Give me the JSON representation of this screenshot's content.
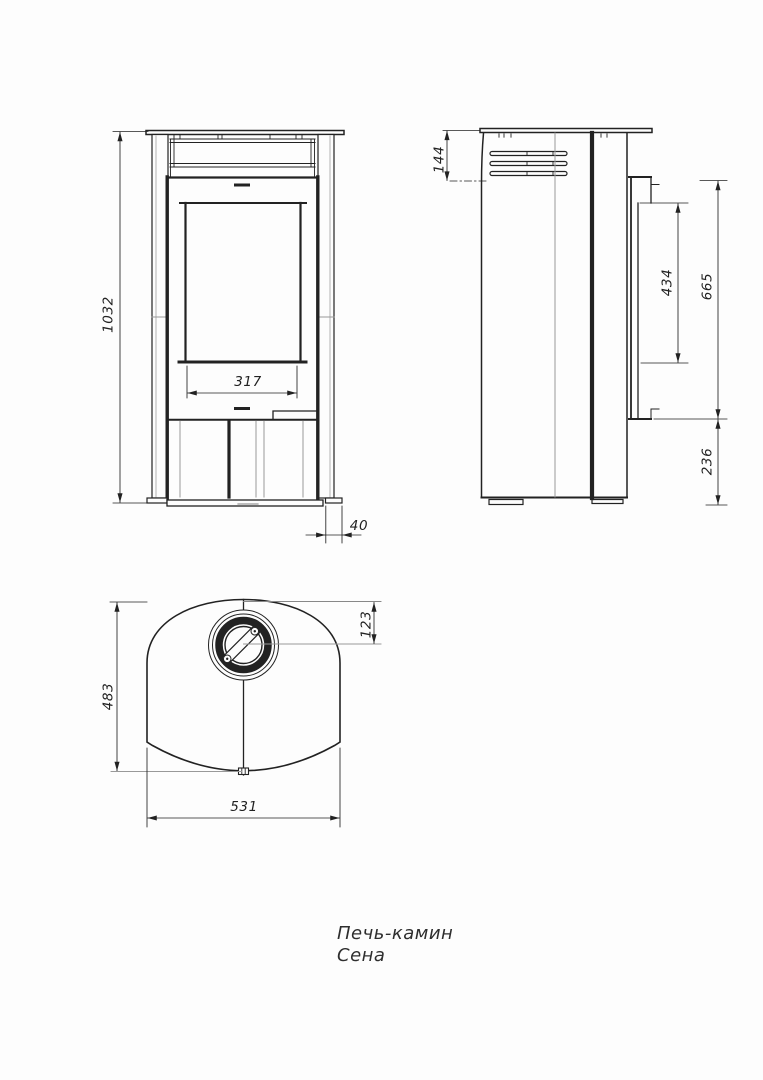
{
  "drawing": {
    "title": {
      "line1": "Печь-камин",
      "line2": "Сена"
    },
    "dimensions": {
      "front": {
        "overall_height": "1032",
        "glass_width": "317",
        "top_plate_offset": "40"
      },
      "side": {
        "top_vent_height": "144",
        "rear_shield_height": "434",
        "rear_shield_top": "665",
        "rear_shield_bottom": "236"
      },
      "top": {
        "depth": "483",
        "flue_offset": "123",
        "width": "531"
      }
    },
    "colors": {
      "background": "#fdfdfd",
      "line": "#222222",
      "construction": "#999999"
    }
  }
}
